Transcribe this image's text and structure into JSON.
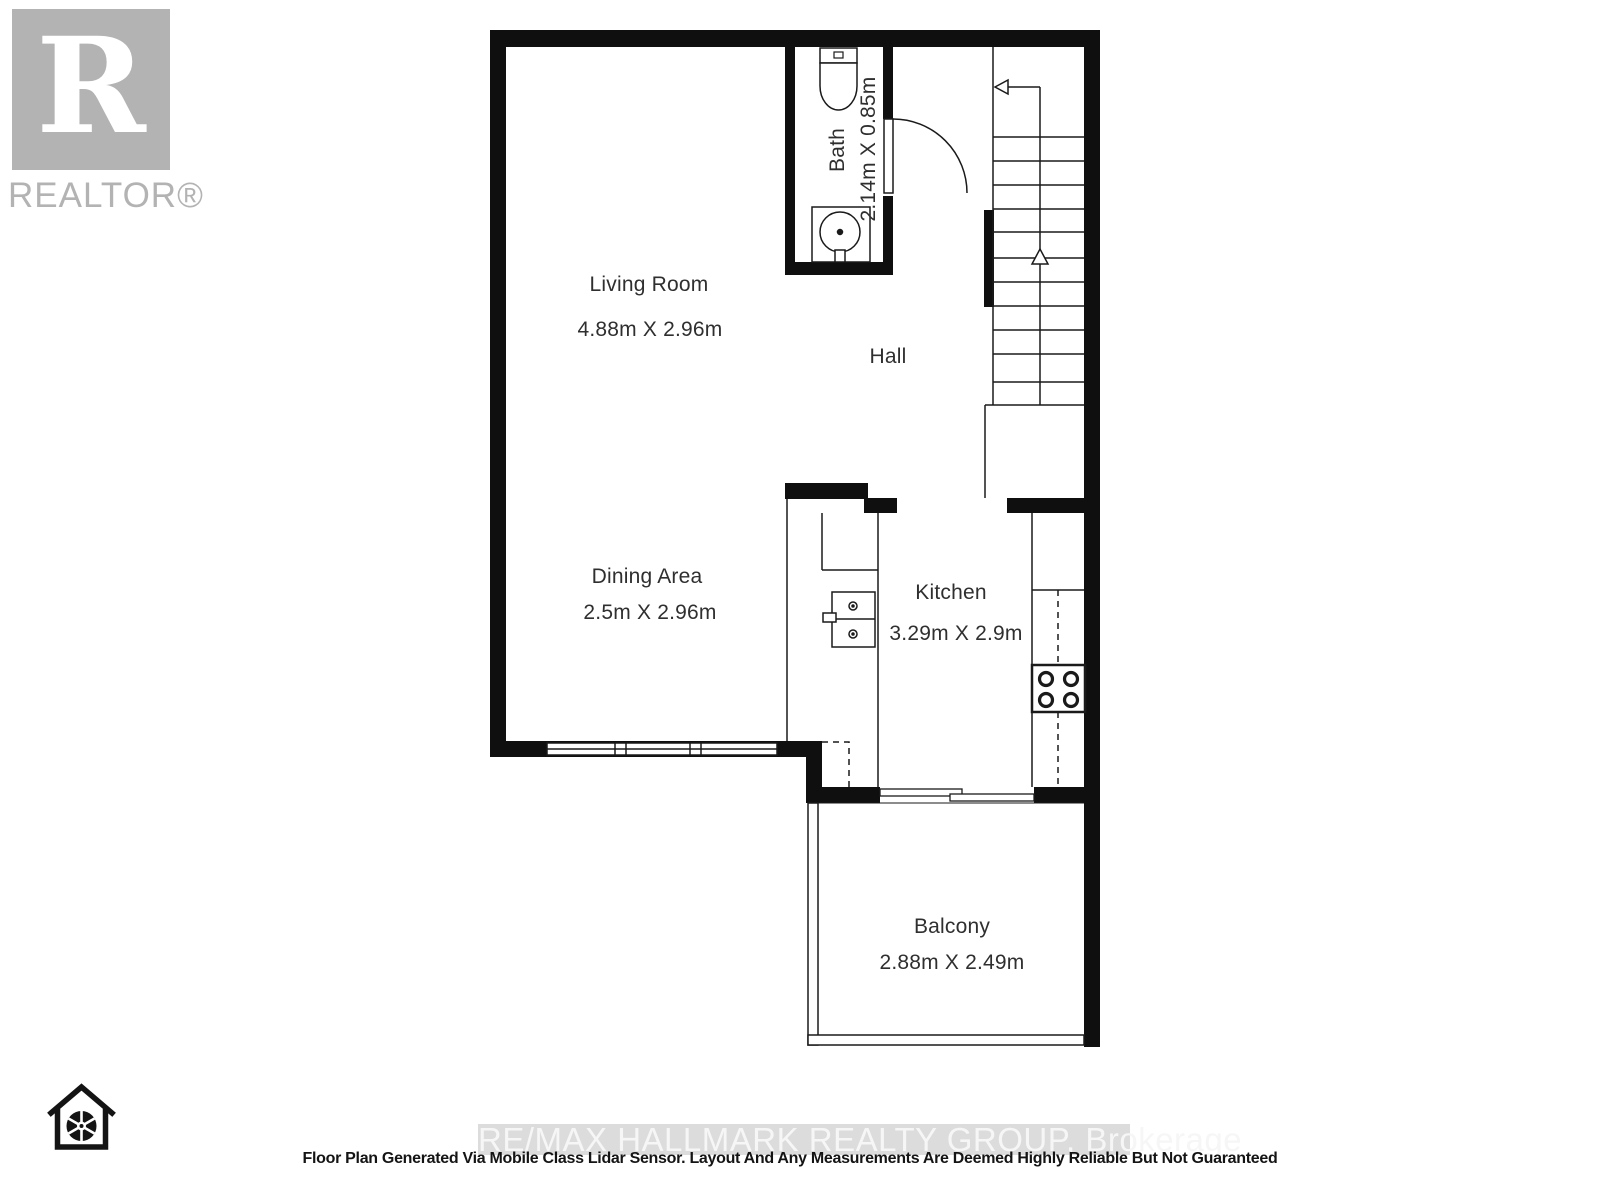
{
  "branding": {
    "logo_letter": "R",
    "logo_wordmark": "REALTOR®"
  },
  "rooms": {
    "living_room": {
      "name": "Living Room",
      "dims": "4.88m X 2.96m"
    },
    "dining_area": {
      "name": "Dining Area",
      "dims": "2.5m X 2.96m"
    },
    "kitchen": {
      "name": "Kitchen",
      "dims": "3.29m X 2.9m"
    },
    "bath": {
      "name": "Bath",
      "dims": "2.14m X 0.85m"
    },
    "hall": {
      "name": "Hall"
    },
    "balcony": {
      "name": "Balcony",
      "dims": "2.88m X 2.49m"
    }
  },
  "footer": {
    "watermark": "RE/MAX HALLMARK REALTY GROUP,  Brokerage",
    "disclaimer": "Floor Plan Generated Via Mobile Class Lidar Sensor. Layout And Any Measurements Are Deemed Highly Reliable But Not Guaranteed"
  },
  "icons": {
    "logo": "realtor-block-r-logo",
    "camera": "house-aperture-icon",
    "fixtures": [
      "toilet-icon",
      "bathroom-sink-icon",
      "kitchen-sink-icon",
      "stove-icon"
    ],
    "stairs": [
      "up-arrow-icon",
      "left-arrow-icon"
    ]
  },
  "colors": {
    "wall": "#0f0f0f",
    "label_text": "#2f2f2f",
    "logo_gray": "#b3b3b3",
    "watermark_bg": "#dcdcdc",
    "watermark_text": "#f6f6f6"
  }
}
